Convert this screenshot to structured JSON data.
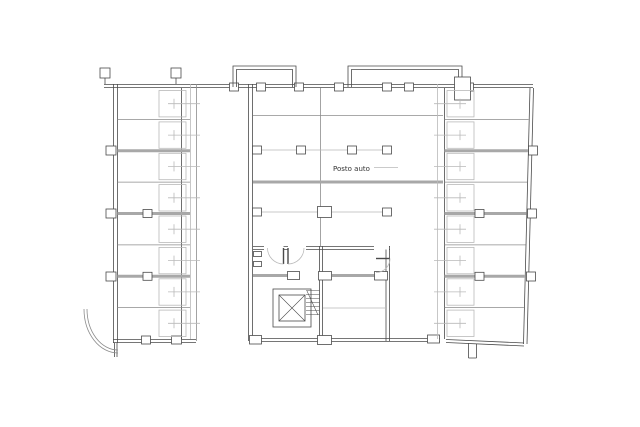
{
  "plan": {
    "parking_label": "Posto auto",
    "left_block": {
      "garage_count": 8
    },
    "right_block": {
      "garage_count": 8
    },
    "core_features": [
      "elevator",
      "stairs",
      "wc-room",
      "entry-doors"
    ]
  },
  "colors": {
    "background": "#ffffff",
    "line_dark": "#4a4a4a",
    "line_mid": "#8c8c8c",
    "line_light": "#b9b9b9",
    "wall_gray": "#a8a8a8",
    "text": "#333333"
  }
}
